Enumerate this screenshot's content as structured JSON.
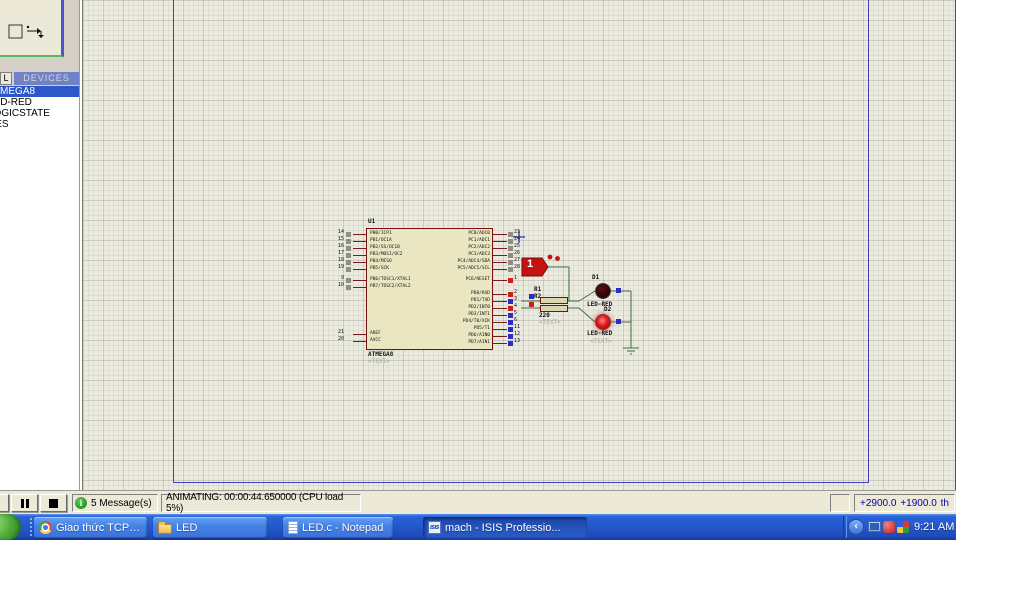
{
  "colors": {
    "canvas_bg": "#EAEADF",
    "sheet_border": "#4242B4",
    "wire_green": "#3E6F3E",
    "component_body": "#EAE6C2",
    "component_outline": "#7A1010",
    "state_red": "#CC2020",
    "state_blue": "#2C2CC8",
    "state_gray": "#8F8F85",
    "selection_blue": "#2E58C8",
    "taskbar_blue": "#2458CE",
    "led_on": "#E01818"
  },
  "object_selector": {
    "tab_button": "L",
    "header": "DEVICES",
    "devices": [
      {
        "name": "ATMEGA8",
        "selected": true
      },
      {
        "name": "LED-RED",
        "selected": false
      },
      {
        "name": "LOGICSTATE",
        "selected": false
      },
      {
        "name": "RES",
        "selected": false
      }
    ]
  },
  "schematic": {
    "mcu": {
      "ref": "U1",
      "part": "ATMEGA8",
      "text": "<TEXT>",
      "left_pins": [
        {
          "num": "14",
          "label": "PB0/ICP1",
          "state": "gray"
        },
        {
          "num": "15",
          "label": "PB1/OC1A",
          "state": "gray"
        },
        {
          "num": "16",
          "label": "PB2/SS/OC1B",
          "state": "gray"
        },
        {
          "num": "17",
          "label": "PB3/MOSI/OC2",
          "state": "gray"
        },
        {
          "num": "18",
          "label": "PB4/MISO",
          "state": "gray"
        },
        {
          "num": "19",
          "label": "PB5/SCK",
          "state": "gray"
        },
        {
          "num": "9",
          "label": "PB6/TOSC1/XTAL1",
          "state": "gray"
        },
        {
          "num": "10",
          "label": "PB7/TOSC2/XTAL2",
          "state": "gray"
        }
      ],
      "power_pins": [
        {
          "num": "21",
          "label": "AREF",
          "state": null
        },
        {
          "num": "20",
          "label": "AVCC",
          "state": null
        }
      ],
      "right_pins": [
        {
          "num": "23",
          "label": "PC0/ADC0",
          "state": "gray"
        },
        {
          "num": "24",
          "label": "PC1/ADC1",
          "state": "gray"
        },
        {
          "num": "25",
          "label": "PC2/ADC2",
          "state": "gray"
        },
        {
          "num": "26",
          "label": "PC3/ADC3",
          "state": "gray"
        },
        {
          "num": "27",
          "label": "PC4/ADC4/SDA",
          "state": "gray"
        },
        {
          "num": "28",
          "label": "PC5/ADC5/SCL",
          "state": "gray"
        },
        {
          "num": "1",
          "label": "PC6/RESET",
          "state": "red"
        }
      ],
      "right_pins2": [
        {
          "num": "2",
          "label": "PD0/RXD",
          "state": "red"
        },
        {
          "num": "3",
          "label": "PD1/TXD",
          "state": "blue"
        },
        {
          "num": "4",
          "label": "PD2/INT0",
          "state": "red"
        },
        {
          "num": "5",
          "label": "PD3/INT1",
          "state": "blue"
        },
        {
          "num": "6",
          "label": "PD4/T0/XCK",
          "state": "blue"
        },
        {
          "num": "11",
          "label": "PD5/T1",
          "state": "blue"
        },
        {
          "num": "12",
          "label": "PD6/AIN0",
          "state": "blue"
        },
        {
          "num": "13",
          "label": "PD7/AIN1",
          "state": "blue"
        }
      ]
    },
    "logicstate": {
      "value": "1"
    },
    "resistors": {
      "r1_ref": "R1",
      "r2_ref": "R2",
      "value": "220",
      "text": "<TEXT>"
    },
    "wire_indicators": [
      {
        "state": "blue"
      },
      {
        "state": "red"
      }
    ],
    "leds": [
      {
        "ref": "D1",
        "part": "LED-RED",
        "on": false,
        "state": "blue"
      },
      {
        "ref": "D2",
        "part": "LED-RED",
        "on": true,
        "state": "blue",
        "text": "<TEXT>"
      }
    ]
  },
  "status_bar": {
    "playback": [
      {
        "name": "play-partial"
      },
      {
        "name": "pause"
      },
      {
        "name": "stop"
      }
    ],
    "messages": "5 Message(s)",
    "animating": "ANIMATING: 00:00:44.650000 (CPU load 5%)",
    "coordinates": {
      "x": "+2900.0",
      "y": "+1900.0",
      "units": "th"
    }
  },
  "taskbar": {
    "buttons": [
      {
        "label": "Giao thức TCP/IP và ...",
        "icon": "chrome",
        "active": false
      },
      {
        "label": "LED",
        "icon": "folder",
        "active": false
      },
      {
        "label": "LED.c - Notepad",
        "icon": "notepad",
        "active": false
      },
      {
        "label": "mach - ISIS Professio...",
        "icon": "isis",
        "active": true
      }
    ],
    "tray": {
      "icons": [
        "hide-chevron",
        "network",
        "messenger",
        "antivirus"
      ],
      "time": "9:21 AM"
    }
  }
}
